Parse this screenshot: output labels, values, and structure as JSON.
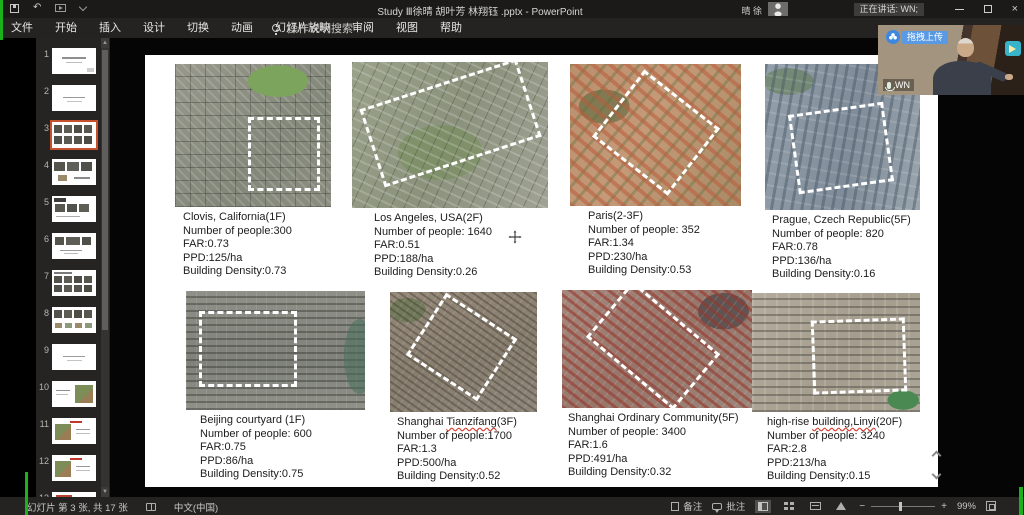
{
  "titlebar": {
    "title": "Study Ⅲ徐晴 胡叶芳 林翔钰 .pptx - PowerPoint",
    "user": "晴 徐",
    "speaking_badge": "正在讲话: WN;"
  },
  "menu": {
    "items": [
      {
        "label": "文件"
      },
      {
        "label": "开始"
      },
      {
        "label": "插入"
      },
      {
        "label": "设计"
      },
      {
        "label": "切换"
      },
      {
        "label": "动画"
      },
      {
        "label": "幻灯片放映"
      },
      {
        "label": "审阅"
      },
      {
        "label": "视图"
      },
      {
        "label": "帮助"
      }
    ],
    "search_label": "操作说明搜索"
  },
  "sidebar": {
    "thumbnails": [
      {
        "num": "1",
        "kind": "t-title"
      },
      {
        "num": "2",
        "kind": "t-text"
      },
      {
        "num": "3",
        "kind": "t-grid8 sel"
      },
      {
        "num": "4",
        "kind": "t-media"
      },
      {
        "num": "5",
        "kind": "t-media2"
      },
      {
        "num": "6",
        "kind": "t-row3"
      },
      {
        "num": "7",
        "kind": "t-grid8h"
      },
      {
        "num": "8",
        "kind": "t-charts"
      },
      {
        "num": "9",
        "kind": "t-text"
      },
      {
        "num": "10",
        "kind": "t-map-r"
      },
      {
        "num": "11",
        "kind": "t-map-l"
      },
      {
        "num": "12",
        "kind": "t-map-l"
      },
      {
        "num": "13",
        "kind": "t-partial"
      }
    ]
  },
  "slide": {
    "cards": [
      {
        "pre": "Clovis, California(1F)",
        "mark": "",
        "post": "",
        "people": "Number of people:300",
        "far": "FAR:0.73",
        "ppd": "PPD:125/ha",
        "density": "Building Density:0.73",
        "img": "sat-clovis",
        "roi": "roi-1"
      },
      {
        "pre": "Los Angeles, USA(2F)",
        "mark": "",
        "post": "",
        "people": "Number of people: 1640",
        "far": "FAR:0.51",
        "ppd": "PPD:188/ha",
        "density": "Building Density:0.26",
        "img": "sat-la",
        "roi": "roi-2"
      },
      {
        "pre": "Paris(2-3F)",
        "mark": "",
        "post": "",
        "people": "Number of people: 352",
        "far": "FAR:1.34",
        "ppd": "PPD:230/ha",
        "density": "Building Density:0.53",
        "img": "sat-paris",
        "roi": "roi-3"
      },
      {
        "pre": "Prague, Czech Republic(5F)",
        "mark": "",
        "post": "",
        "people": "Number of people: 820",
        "far": "FAR:0.78",
        "ppd": "PPD:136/ha",
        "density": "Building Density:0.16",
        "img": "sat-prague",
        "roi": "roi-4"
      },
      {
        "pre": "Beijing courtyard (1F)",
        "mark": "",
        "post": "",
        "people": "Number of people: 600",
        "far": "FAR:0.75",
        "ppd": "PPD:86/ha",
        "density": "Building Density:0.75",
        "img": "sat-beijing",
        "roi": "roi-5"
      },
      {
        "pre": "Shanghai ",
        "mark": "Tianzifang",
        "post": "(3F)",
        "people": "Number of people:1700",
        "far": "FAR:1.3",
        "ppd": "PPD:500/ha",
        "density": "Building Density:0.52",
        "img": "sat-tianzifang",
        "roi": "roi-6"
      },
      {
        "pre": "Shanghai Ordinary Community(5F)",
        "mark": "",
        "post": "",
        "people": "Number of people: 3400",
        "far": "FAR:1.6",
        "ppd": "PPD:491/ha",
        "density": "Building Density:0.32",
        "img": "sat-ordinary",
        "roi": "roi-7"
      },
      {
        "pre": "high-rise ",
        "mark": "building,Linyi",
        "post": "(20F)",
        "people": "Number of people: 3240",
        "far": "FAR:2.8",
        "ppd": "PPD:213/ha",
        "density": "Building Density:0.15",
        "img": "sat-linyi",
        "roi": "roi-8"
      }
    ]
  },
  "meeting": {
    "upload_badge": "拖拽上传",
    "speaker_label": "WN"
  },
  "statusbar": {
    "slide_info": "幻灯片 第 3 张, 共 17 张",
    "language": "中文(中国)",
    "notes_label": "备注",
    "comments_label": "批注",
    "zoom_level": "99%"
  }
}
